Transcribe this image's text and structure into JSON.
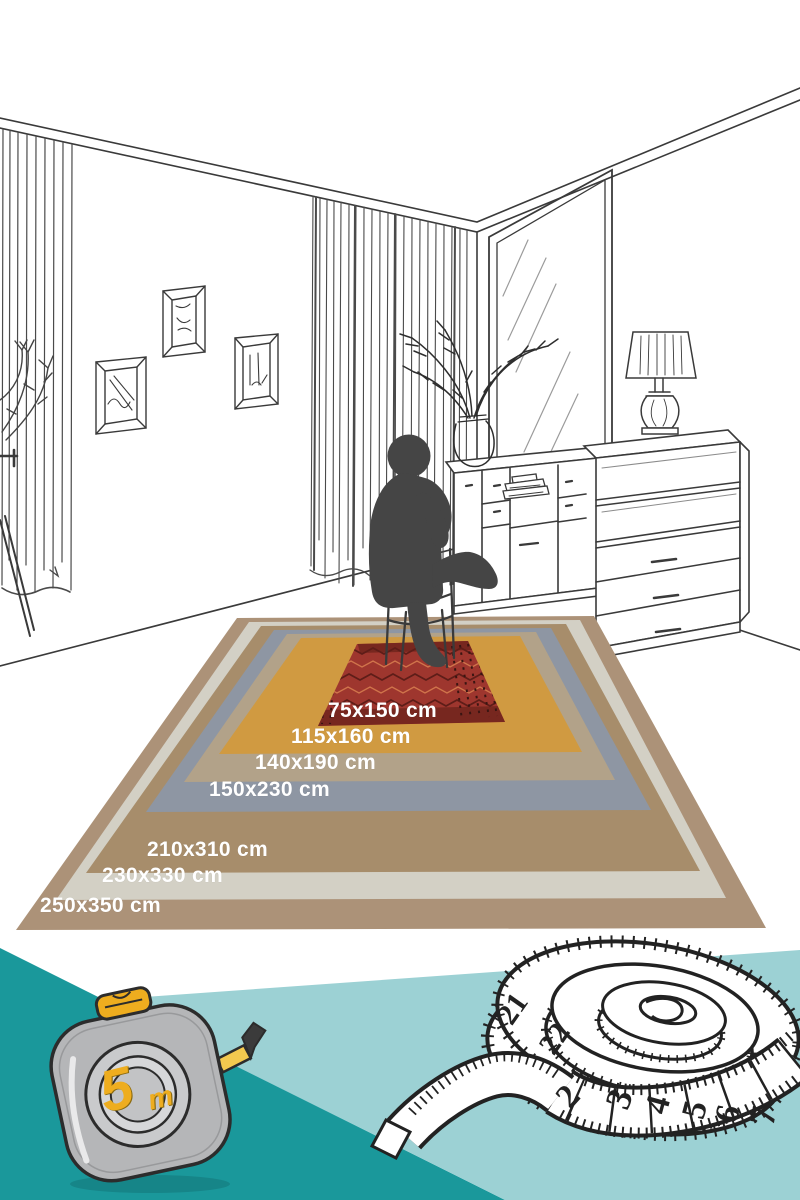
{
  "rug_layers": [
    {
      "label": "75x150 cm",
      "color": "#9e362e"
    },
    {
      "label": "115x160 cm",
      "color": "#d09a41"
    },
    {
      "label": "140x190 cm",
      "color": "#b2a289"
    },
    {
      "label": "150x230 cm",
      "color": "#8e96a3"
    },
    {
      "label": "210x310 cm",
      "color": "#a78d6b"
    },
    {
      "label": "230x330 cm",
      "color": "#d3d0c5"
    },
    {
      "label": "250x350 cm",
      "color": "#ac9278"
    }
  ],
  "tape_measure": {
    "capacity": "5",
    "unit": "m"
  },
  "measuring_tape": {
    "numbers": [
      "21",
      "22",
      "2",
      "3",
      "4",
      "5",
      "6",
      "7"
    ]
  },
  "palette": {
    "dark_teal": "#1a989b",
    "light_teal": "#9cd1d4",
    "silhouette": "#454545",
    "line": "#3a3a3a",
    "tape_yellow": "#eead1f"
  }
}
